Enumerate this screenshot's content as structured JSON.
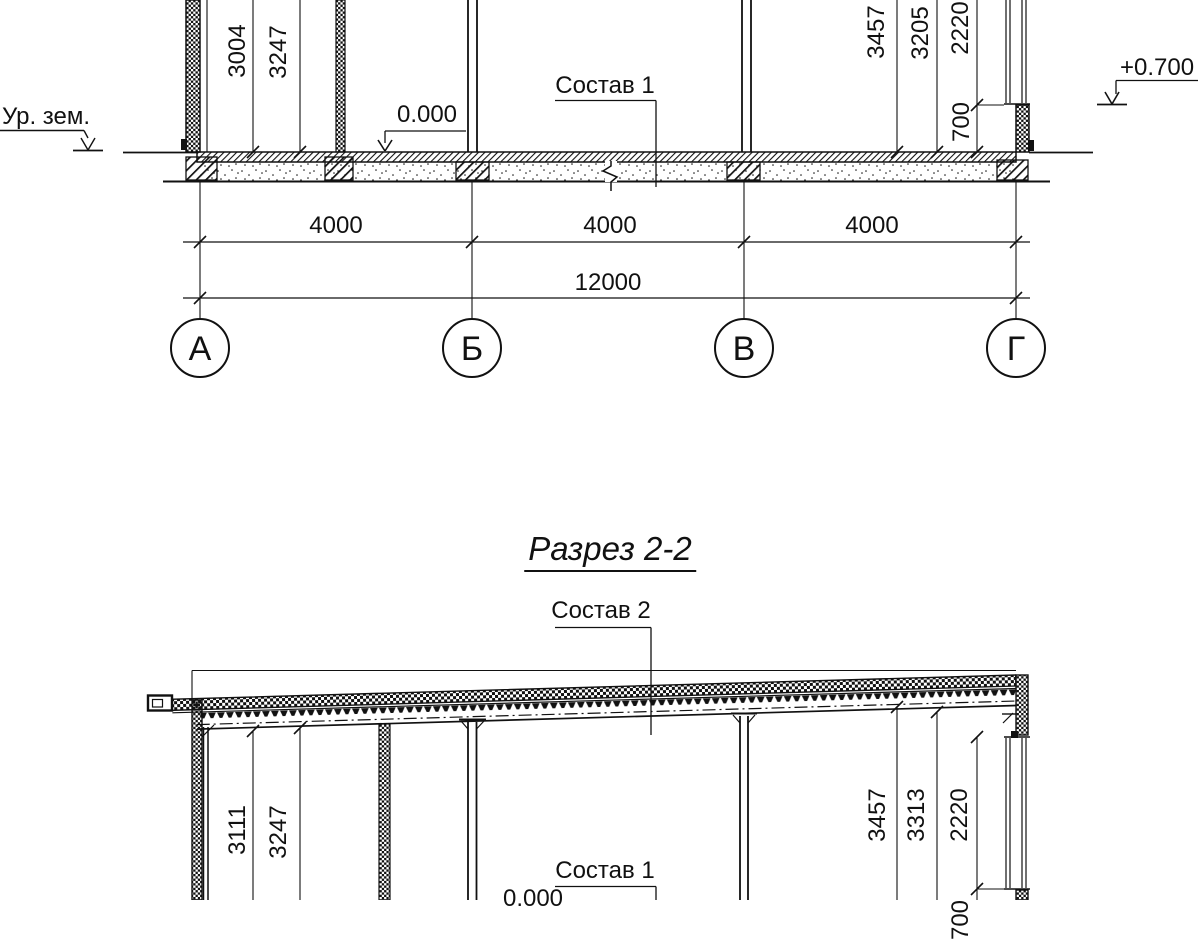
{
  "title": "Разрез 2-2",
  "section1": {
    "ground_label": "Ур. зем.",
    "elev_zero": "0.000",
    "elev_top": "+0.700",
    "layer_label": "Состав 1",
    "dims_left": [
      "3004",
      "3247"
    ],
    "dims_right": [
      "3457",
      "3205",
      "2220",
      "700"
    ],
    "span_dims": [
      "4000",
      "4000",
      "4000"
    ],
    "total_dim": "12000",
    "axes": [
      "А",
      "Б",
      "В",
      "Г"
    ]
  },
  "section2": {
    "roof_layer_label": "Состав 2",
    "floor_layer_label": "Состав 1",
    "elev_zero": "0.000",
    "dims_left": [
      "3111",
      "3247"
    ],
    "dims_right": [
      "3457",
      "3313",
      "2220",
      "700"
    ]
  }
}
